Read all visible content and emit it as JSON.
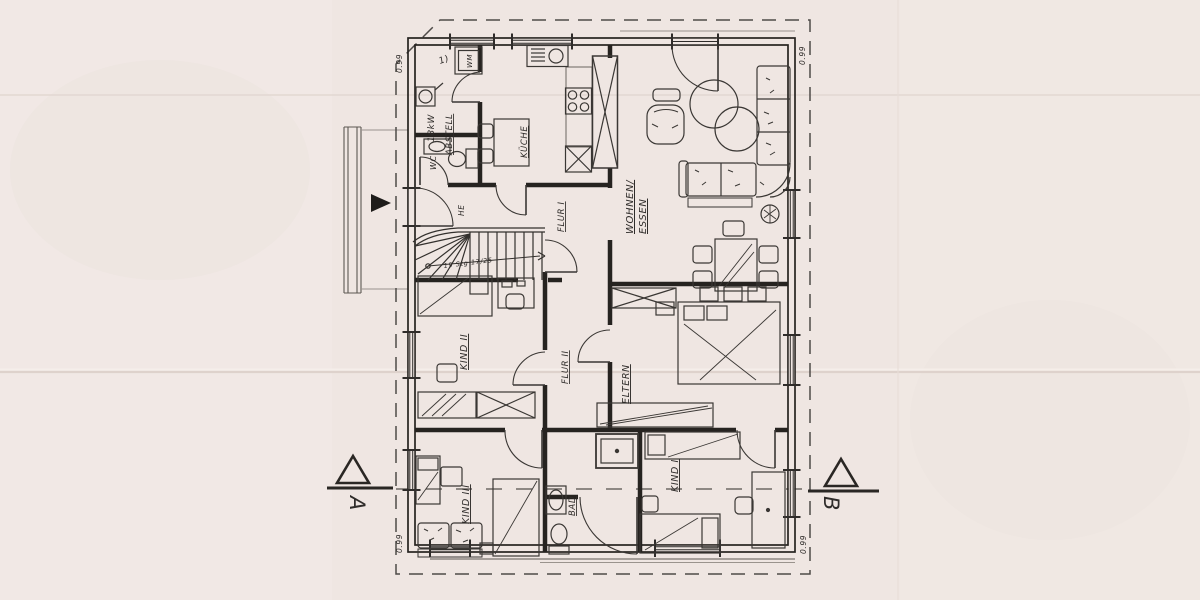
{
  "plan": {
    "rooms": [
      {
        "id": "abstell",
        "label": "ABSTELL"
      },
      {
        "id": "wc",
        "label": "WC"
      },
      {
        "id": "kueche",
        "label": "KÜCHE"
      },
      {
        "id": "wohnen_essen",
        "label": "WOHNEN/",
        "label2": "ESSEN"
      },
      {
        "id": "flur1",
        "label": "FLUR I"
      },
      {
        "id": "kind2",
        "label": "KIND II"
      },
      {
        "id": "flur2",
        "label": "FLUR II"
      },
      {
        "id": "eltern",
        "label": "ELTERN"
      },
      {
        "id": "bad",
        "label": "BAD"
      },
      {
        "id": "kind1",
        "label": "KIND I"
      },
      {
        "id": "kind3",
        "label": "KIND III"
      }
    ],
    "annotations": {
      "boiler": "18kW",
      "washing_machine": "WM",
      "entrance": "HE",
      "door_note": "1)",
      "stairs_note": "19 Stg 17/25"
    },
    "section_markers": {
      "left": "A",
      "right": "B"
    },
    "dimensions": {
      "top_left": "0.99",
      "top_right": "0.99",
      "bottom_left": "0.99",
      "bottom_right": "0.99"
    },
    "colors": {
      "paper": "#efe6e2",
      "ink": "#2f2c2a",
      "wall": "#262320"
    }
  }
}
